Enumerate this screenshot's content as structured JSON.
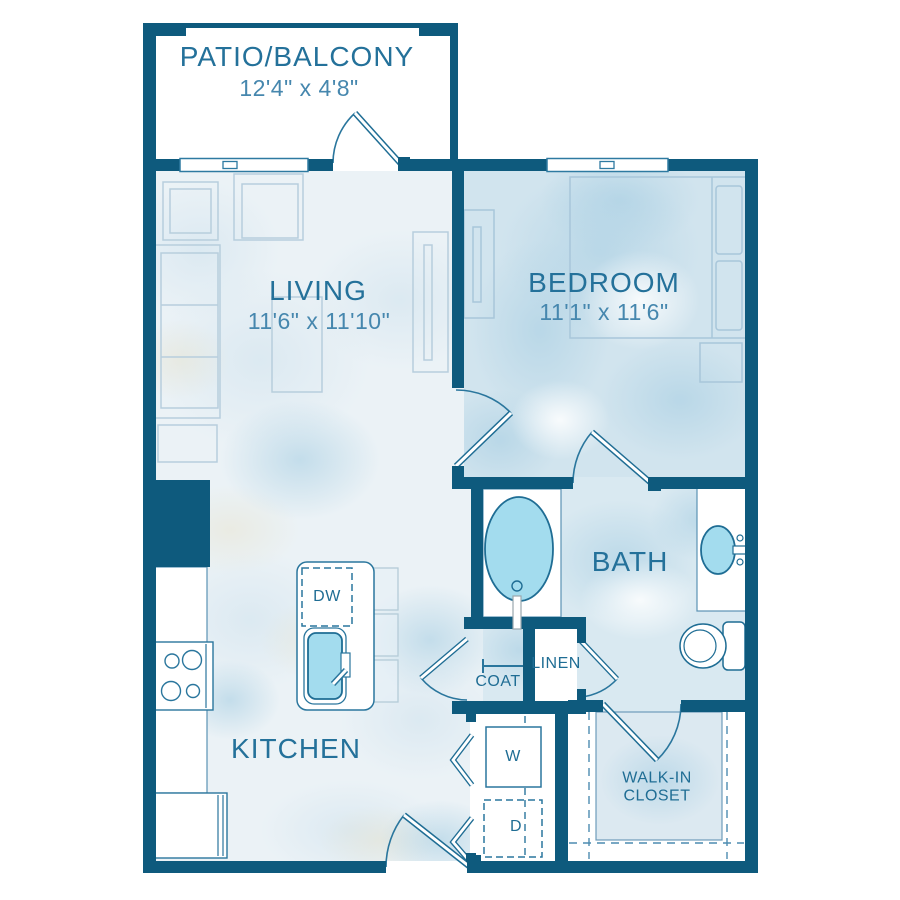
{
  "rooms": {
    "patio": {
      "label": "PATIO/BALCONY",
      "dims": "12'4\" x 4'8\""
    },
    "living": {
      "label": "LIVING",
      "dims": "11'6\" x 11'10\""
    },
    "bedroom": {
      "label": "BEDROOM",
      "dims": "11'1\" x 11'6\""
    },
    "bath": {
      "label": "BATH"
    },
    "kitchen": {
      "label": "KITCHEN"
    },
    "walk_in_closet": {
      "line1": "WALK-IN",
      "line2": "CLOSET"
    }
  },
  "closets": {
    "coat": "COAT",
    "linen": "LINEN"
  },
  "appliances": {
    "dishwasher": "DW",
    "washer": "W",
    "dryer": "D"
  },
  "colors": {
    "wall": "#0e5a7d",
    "room_label": "#24719a",
    "dimension_label": "#4687ae",
    "fixture_fill": "#a3dcee",
    "fixture_stroke": "#1f6d94",
    "furniture_stroke": "#b7cedd",
    "floor_light": "#ebf2f6",
    "floor_bedroom": "#d1e4ee",
    "floor_bath": "#d9e9f1"
  }
}
